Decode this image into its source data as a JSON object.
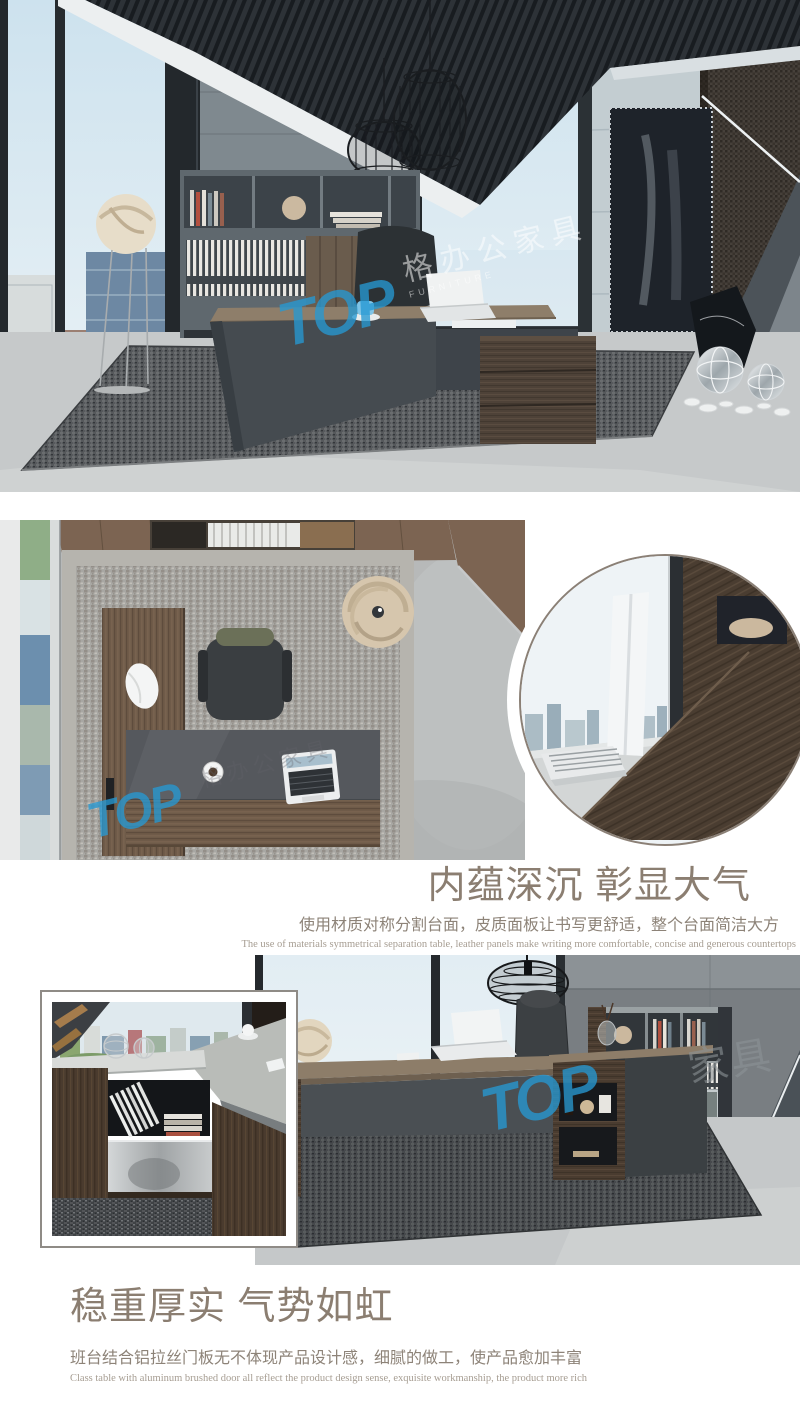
{
  "page": {
    "background": "#ffffff"
  },
  "brand": {
    "watermark_logo": "TOP",
    "watermark_cn": "格办公家具",
    "watermark_cn_short": "家具",
    "watermark_en": "FURNITURE",
    "watermark_color": "#2a9ad2"
  },
  "section1": {
    "heading": "内蕴深沉 彰显大气",
    "subheading": "使用材质对称分割台面，皮质面板让书写更舒适，整个台面简洁大方",
    "subheading_en": "The use of materials symmetrical separation table, leather panels make writing more comfortable, concise and generous countertops"
  },
  "section2": {
    "heading": "稳重厚实 气势如虹",
    "subheading": "班台结合铝拉丝门板无不体现产品设计感，细腻的做工，使产品愈加丰富",
    "subheading_en": "Class table with aluminum brushed door all reflect the product design sense, exquisite workmanship, the product more rich"
  },
  "colors": {
    "heading_text": "#8b7e71",
    "body_text": "#8d8378",
    "caption_text": "#a69d92"
  }
}
